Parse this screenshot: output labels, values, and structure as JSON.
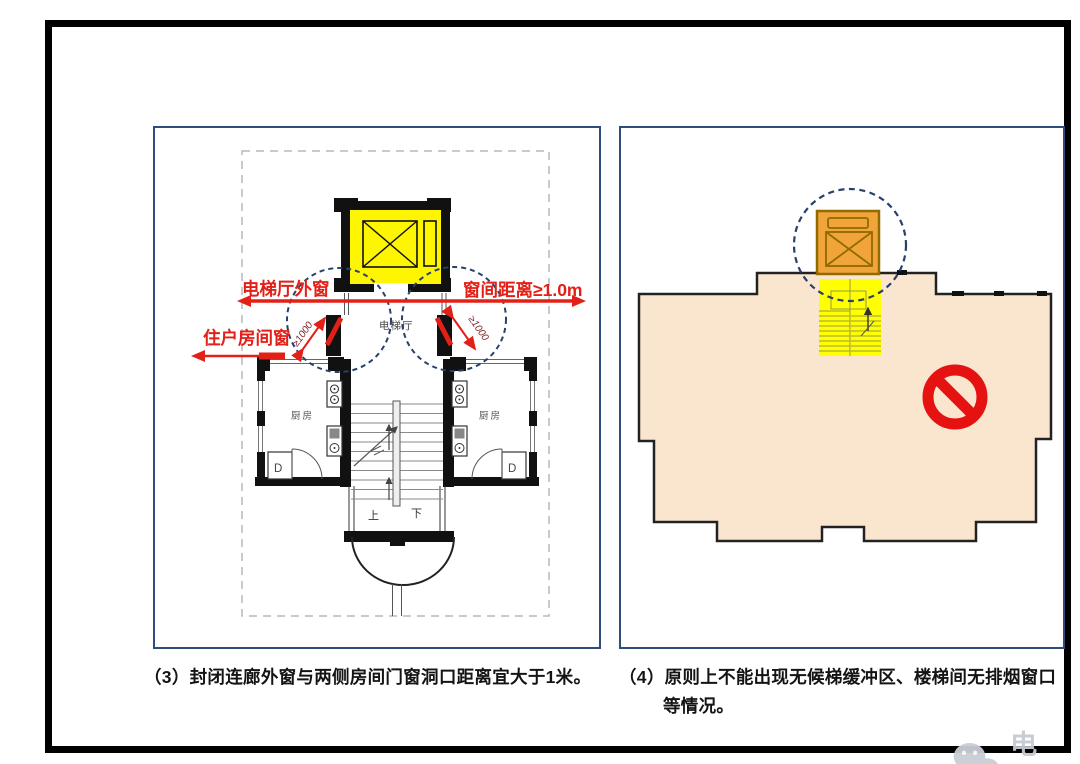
{
  "slide": {
    "type": "presentation-figure",
    "topic": "elevator installation plan requirements"
  },
  "left_panel": {
    "labels": {
      "hall_window": "电梯厅外窗",
      "distance": "窗间距离≥1.0m",
      "resident_window": "住户房间窗",
      "dim": "≥1000",
      "hall": "电梯厅",
      "kitchen": "厨房",
      "up": "上",
      "down": "下",
      "d": "D"
    }
  },
  "right_panel": {
    "labels": {}
  },
  "captions": {
    "c3": "（3）封闭连廊外窗与两侧房间门窗洞口距离宜大于1米。",
    "c4_line1": "（4）原则上不能出现无候梯缓冲区、楼梯间无排烟窗口",
    "c4_line2": "等情况。"
  },
  "watermark": {
    "text": "电梯"
  },
  "colors": {
    "annotation_red": "#e32017",
    "dim_text_red": "#7c1f1f",
    "circle_navy": "#26416b",
    "panel_border_blue": "#2e4d7c",
    "shaft_yellow": "#fef500",
    "shaft_orange": "#f1a43a",
    "stair_yellow": "#ffff00",
    "building_fill": "#fae6cf",
    "prohibition_red": "#e61212",
    "wall_black": "#111111",
    "boundary_gray": "#b8b8b8"
  }
}
